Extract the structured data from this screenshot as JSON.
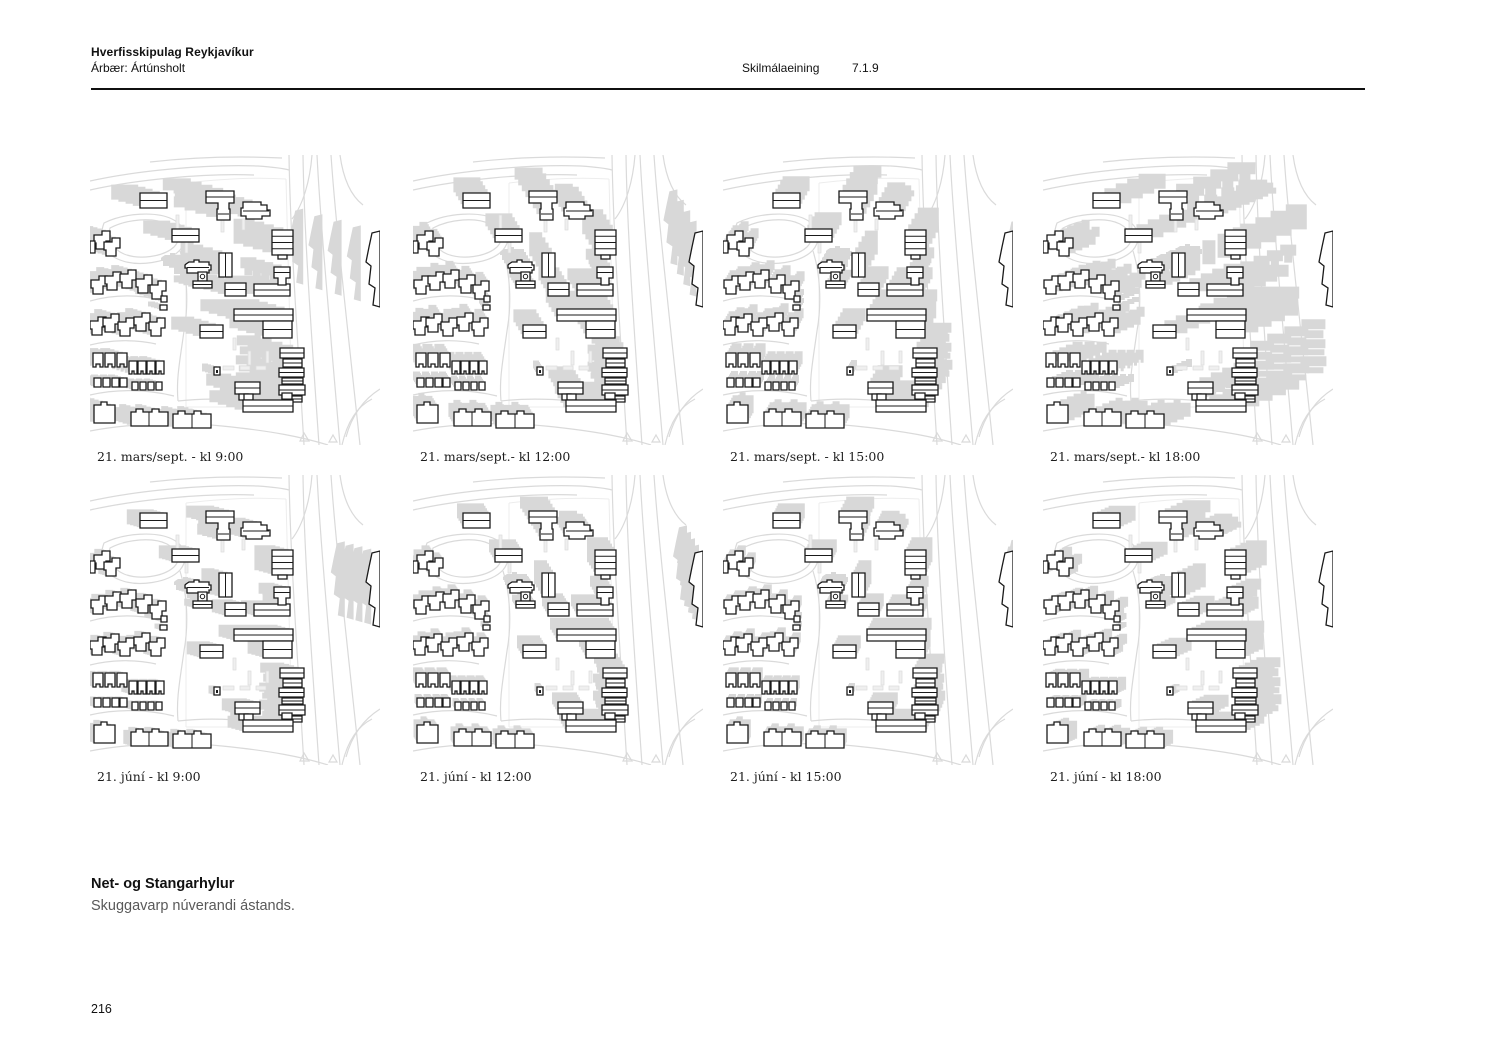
{
  "header": {
    "title": "Hverfisskipulag Reykjavíkur",
    "area": "Árbær: Ártúnsholt",
    "section_label": "Skilmálaeining",
    "section_code": "7.1.9"
  },
  "panels": [
    {
      "id": "mars-0900",
      "date": "21. mars/sept.",
      "time": "kl 9:00",
      "caption": "21. mars/sept. - kl 9:00",
      "shadow_dx": -24,
      "shadow_dy": -7
    },
    {
      "id": "mars-1200",
      "date": "21. mars/sept.",
      "time": "kl 12:00",
      "caption": "21. mars/sept.- kl 12:00",
      "shadow_dx": -8,
      "shadow_dy": -13
    },
    {
      "id": "mars-1500",
      "date": "21. mars/sept.",
      "time": "kl 15:00",
      "caption": "21. mars/sept. - kl 15:00",
      "shadow_dx": 8,
      "shadow_dy": -14
    },
    {
      "id": "mars-1800",
      "date": "21. mars/sept.",
      "time": "kl 18:00",
      "caption": "21. mars/sept.- kl 18:00",
      "shadow_dx": 38,
      "shadow_dy": -16
    },
    {
      "id": "juni-0900",
      "date": "21. júní",
      "time": "kl 9:00",
      "caption": "21. júní - kl 9:00",
      "shadow_dx": -11,
      "shadow_dy": -3
    },
    {
      "id": "juni-1200",
      "date": "21. júní",
      "time": "kl 12:00",
      "caption": "21. júní - kl 12:00",
      "shadow_dx": -5,
      "shadow_dy": -8
    },
    {
      "id": "juni-1500",
      "date": "21. júní",
      "time": "kl 15:00",
      "caption": "21. júní - kl 15:00",
      "shadow_dx": 4,
      "shadow_dy": -8
    },
    {
      "id": "juni-1800",
      "date": "21. júní",
      "time": "kl 18:00",
      "caption": "21. júní - kl 18:00",
      "shadow_dx": 13,
      "shadow_dy": -6
    }
  ],
  "map_style": {
    "building_fill": "#ffffff",
    "building_stroke": "#1a1a1a",
    "shadow_color": "#d8d8d8",
    "road_color": "#dadada",
    "faint_color": "#ededed",
    "strip_fill": "#efefef"
  },
  "footer": {
    "title": "Net- og Stangarhylur",
    "subtitle": "Skuggavarp núverandi ástands.",
    "page_number": "216"
  }
}
